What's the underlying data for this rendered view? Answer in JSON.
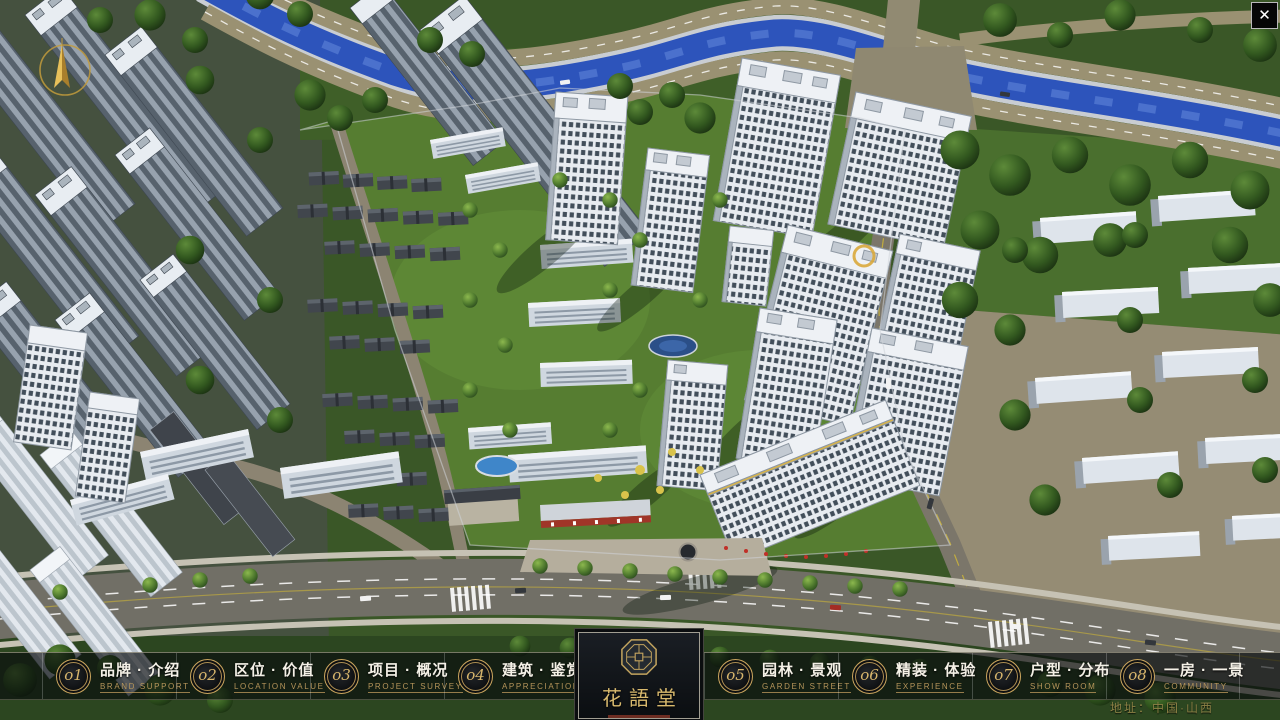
{
  "page": {
    "logo_text": "花語堂",
    "address": "地址：中国·山西"
  },
  "controls": {
    "close_glyph": "✕"
  },
  "nav": {
    "items": [
      {
        "num": "o1",
        "label": "品牌 · 介绍",
        "sublabel": "BRAND SUPPORT"
      },
      {
        "num": "o2",
        "label": "区位 · 价值",
        "sublabel": "LOCATION VALUE"
      },
      {
        "num": "o3",
        "label": "项目 · 概况",
        "sublabel": "PROJECT SURVEY"
      },
      {
        "num": "o4",
        "label": "建筑 · 鉴赏",
        "sublabel": "APPRECIATION"
      },
      {
        "num": "o5",
        "label": "园林 · 景观",
        "sublabel": "GARDEN STREET"
      },
      {
        "num": "o6",
        "label": "精装 · 体验",
        "sublabel": "EXPERIENCE"
      },
      {
        "num": "o7",
        "label": "户型 · 分布",
        "sublabel": "SHOW ROOM"
      },
      {
        "num": "o8",
        "label": "一房 · 一景",
        "sublabel": "COMMUNITY"
      }
    ]
  },
  "colors": {
    "accent_gold": "#c9a45f",
    "nav_text": "#f4f0e6",
    "nav_subtext": "#b6955a",
    "river_blue": "#2d54bb",
    "address_text": "#8c8145"
  }
}
